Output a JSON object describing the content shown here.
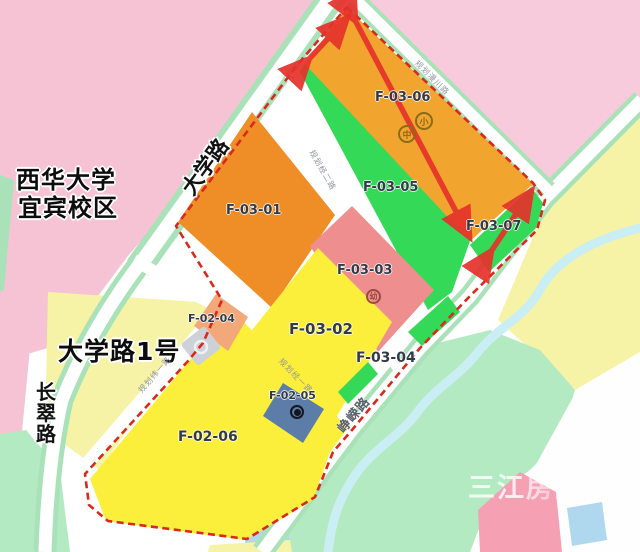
{
  "labels": {
    "campus_line1": "西华大学",
    "campus_line2": "宜宾校区",
    "address": "大学路1号",
    "watermark": "三江房产网"
  },
  "roads": {
    "daxue": "大学路",
    "changcui_chars": [
      "长",
      "翠",
      "路"
    ],
    "zhengrong": "峥嵘路",
    "planned_ne": "规划漫川路",
    "planned_jing2": "规划经二路",
    "planned_jing1": "规划经一路",
    "planned_wei1": "规划纬一路"
  },
  "parcels": {
    "f0301": "F-03-01",
    "f0302": "F-03-02",
    "f0303": "F-03-03",
    "f0304": "F-03-04",
    "f0305": "F-03-05",
    "f0306": "F-03-06",
    "f0307": "F-03-07",
    "f0204": "F-02-04",
    "f0205": "F-02-05",
    "f0206": "F-02-06"
  },
  "icons": {
    "middle_school": "中",
    "primary_school": "小",
    "kindergarten": "幼"
  },
  "colors": {
    "residential_pink": "#F6C3D5",
    "pink_light": "#F8CBDC",
    "orange_parcel": "#EF8E26",
    "orange_parcel_light": "#F2A52E",
    "yellow_parcel": "#FCEF3C",
    "pale_yellow": "#F6F3A7",
    "green_parcel": "#35D958",
    "light_green": "#B4EAC2",
    "road_green_edge": "#A9E2B8",
    "salmon_parcel": "#EE8E8E",
    "salmon_orange": "#F2A878",
    "blue_parcel": "#5B7DA8",
    "stream_blue": "#C9EEF4",
    "boundary_red": "#D9291C",
    "arrow_red": "#E5312B"
  }
}
